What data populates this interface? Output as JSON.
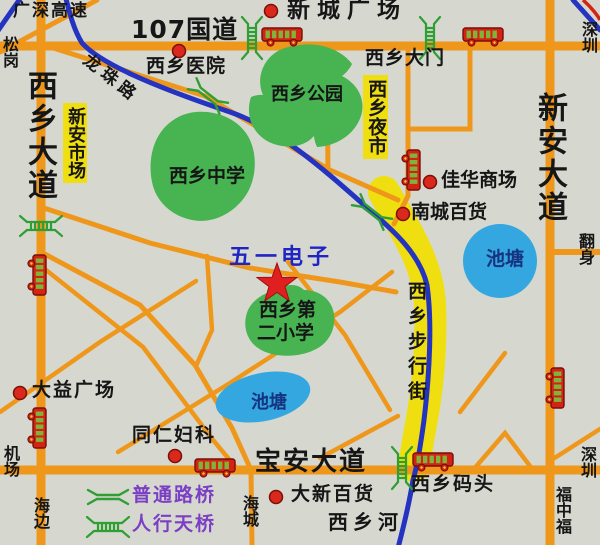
{
  "roads": {
    "guangshen_expressway": "广深高速",
    "g107": "107国道",
    "xixiang_avenue": "西乡大道",
    "xinan_avenue": "新安大道",
    "baoan_avenue": "宝安大道",
    "longzhu_road": "龙珠路",
    "pedestrian_street": "西乡步行街",
    "xixiang_gate": "西乡大门",
    "xixiang_river": "西乡河"
  },
  "places": {
    "xincheng_plaza": "新城广场",
    "xixiang_hospital": "西乡医院",
    "xinan_market": "新安市场",
    "xixiang_night_market": "西乡夜市",
    "jiahua_mall": "佳华商场",
    "nancheng_store": "南城百货",
    "wuyi_electronics": "五一电子",
    "dayi_plaza": "大益广场",
    "tongren_clinic": "同仁妇科",
    "daxin_store": "大新百货",
    "xixiang_wharf": "西乡码头"
  },
  "parks": {
    "xixiang_park": "西乡公园",
    "xixiang_middle_school": "西乡中学",
    "second_primary_line1": "西乡第",
    "second_primary_line2": "二小学"
  },
  "ponds": {
    "pond_right": "池塘",
    "pond_bottom": "池塘"
  },
  "edges": {
    "songgang": "松岗",
    "shenzhen_top": "深圳",
    "fanshen": "翻身",
    "shenzhen_bottom": "深圳",
    "fuzhongfu": "福中福",
    "airport": "机场",
    "haibian": "海边",
    "haicheng": "海城"
  },
  "legend": {
    "road_bridge": "普通路桥",
    "footbridge": "人行天桥"
  },
  "colors": {
    "background": "#d6d8d0",
    "road_orange": "#ef971b",
    "river_blue": "#2433c0",
    "park_green": "#47b351",
    "pond_blue": "#35a7e0",
    "highlight_yellow": "#f0df10",
    "bus_red": "#d42314",
    "dot_red": "#da291c",
    "star_red": "#e02020",
    "legend_purple": "#7b3fc4",
    "label_blue": "#1f24c4"
  }
}
